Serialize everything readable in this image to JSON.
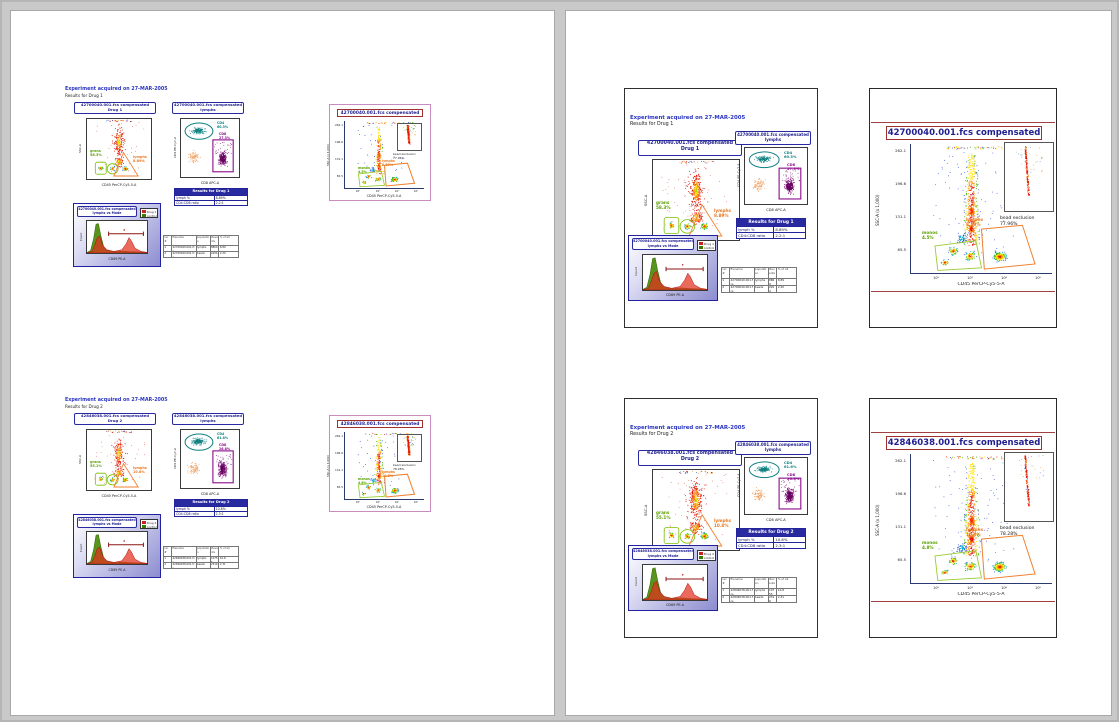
{
  "document": {
    "page_count": 2,
    "background": "#c9c9c9"
  },
  "colors": {
    "navy": "#22229a",
    "title_red": "#a03030",
    "gate_orange": "#e87820",
    "gate_green": "#5a9e00",
    "teal": "#0e8080",
    "purple": "#8a0b8a",
    "legend_red": "#cc2222",
    "legend_green": "#3d7a00"
  },
  "groups": [
    {
      "header": {
        "line1": "Experiment acquired on 27-MAR-2005",
        "line2": "Results for Drug 1"
      },
      "panel_a": {
        "title1": "42700040.001.fcs compensated",
        "title2": "Drug 1",
        "xlabel": "CD45 PerCP-Cy5-5-A",
        "ylabel": "SSC-A",
        "label_green": "grans\n58.3%",
        "label_orange": "lymphs\n8.89%"
      },
      "panel_b": {
        "title1": "42700040.001.fcs compensated",
        "title2": "lymphs",
        "xlabel": "CD8 APC-A",
        "ylabel": "CD4 PE-Cy7-A",
        "label_cd4": "CD4\n60.3%",
        "label_cd8": "CD8\n27.3%"
      },
      "results_table": {
        "title": "Results for Drug 1",
        "rows": [
          {
            "label": "lymph %",
            "value": "8.89%"
          },
          {
            "label": "CD4:CD8 ratio",
            "value": "2.2:1"
          }
        ]
      },
      "hist": {
        "title1": "42700040.001.fcs compensated",
        "title2": "lymphs vs Mode",
        "xlabel": "CD69 PE-A",
        "ylabel": "Count",
        "legend": [
          {
            "label": "Drug 1",
            "color": "#cc2222"
          },
          {
            "label": "control",
            "color": "#3d7a00"
          }
        ]
      },
      "stats_table": {
        "headers": [
          "rec #",
          "filename",
          "population",
          "#events",
          "% of all"
        ],
        "rows": [
          [
            "1",
            "42700040.001.fcs",
            "lymphs",
            "8869",
            "8.89"
          ],
          [
            "2",
            "42700040.001.fcs",
            "beads",
            "2204",
            "2.20"
          ]
        ]
      },
      "large": {
        "title": "42700040.001.fcs compensated",
        "xlabel": "CD45 PerCP-Cy5-5-A",
        "ylabel": "SSC-A (x 1,000)",
        "yticks": [
          "262.1",
          "196.6",
          "131.1",
          "65.5"
        ],
        "xticks": [
          "10²",
          "10³",
          "10⁴",
          "10⁵"
        ],
        "label_orange": "lymphs\n8.89%",
        "label_green": "monos\n4.5%",
        "inset_label": "bead exclusion\n77.96%"
      }
    },
    {
      "header": {
        "line1": "Experiment acquired on 27-MAR-2005",
        "line2": "Results for Drug 2"
      },
      "panel_a": {
        "title1": "42846038.001.fcs compensated",
        "title2": "Drug 2",
        "xlabel": "CD45 PerCP-Cy5-5-A",
        "ylabel": "SSC-A",
        "label_green": "grans\n55.1%",
        "label_orange": "lymphs\n10.8%"
      },
      "panel_b": {
        "title1": "42846038.001.fcs compensated",
        "title2": "lymphs",
        "xlabel": "CD8 APC-A",
        "ylabel": "CD4 PE-Cy7-A",
        "label_cd4": "CD4\n61.6%",
        "label_cd8": "CD8\n26.8%"
      },
      "results_table": {
        "title": "Results for Drug 2",
        "rows": [
          {
            "label": "lymph %",
            "value": "10.8%"
          },
          {
            "label": "CD4:CD8 ratio",
            "value": "2.3:1"
          }
        ]
      },
      "hist": {
        "title1": "42846038.001.fcs compensated",
        "title2": "lymphs vs Mode",
        "xlabel": "CD69 PE-A",
        "ylabel": "Count",
        "legend": [
          {
            "label": "Drug 2",
            "color": "#cc2222"
          },
          {
            "label": "control",
            "color": "#3d7a00"
          }
        ]
      },
      "stats_table": {
        "headers": [
          "rec #",
          "filename",
          "population",
          "#events",
          "% of all"
        ],
        "rows": [
          [
            "1",
            "42846038.001.fcs",
            "lymphs",
            "10755",
            "10.8"
          ],
          [
            "2",
            "42846038.001.fcs",
            "beads",
            "2310",
            "2.31"
          ]
        ]
      },
      "large": {
        "title": "42846038.001.fcs compensated",
        "xlabel": "CD45 PerCP-Cy5-5-A",
        "ylabel": "SSC-A (x 1,000)",
        "yticks": [
          "262.1",
          "196.6",
          "131.1",
          "65.5"
        ],
        "xticks": [
          "10²",
          "10³",
          "10⁴",
          "10⁵"
        ],
        "label_orange": "lymphs\n10.8%",
        "label_green": "monos\n4.8%",
        "inset_label": "bead exclusion\n78.28%"
      }
    }
  ]
}
